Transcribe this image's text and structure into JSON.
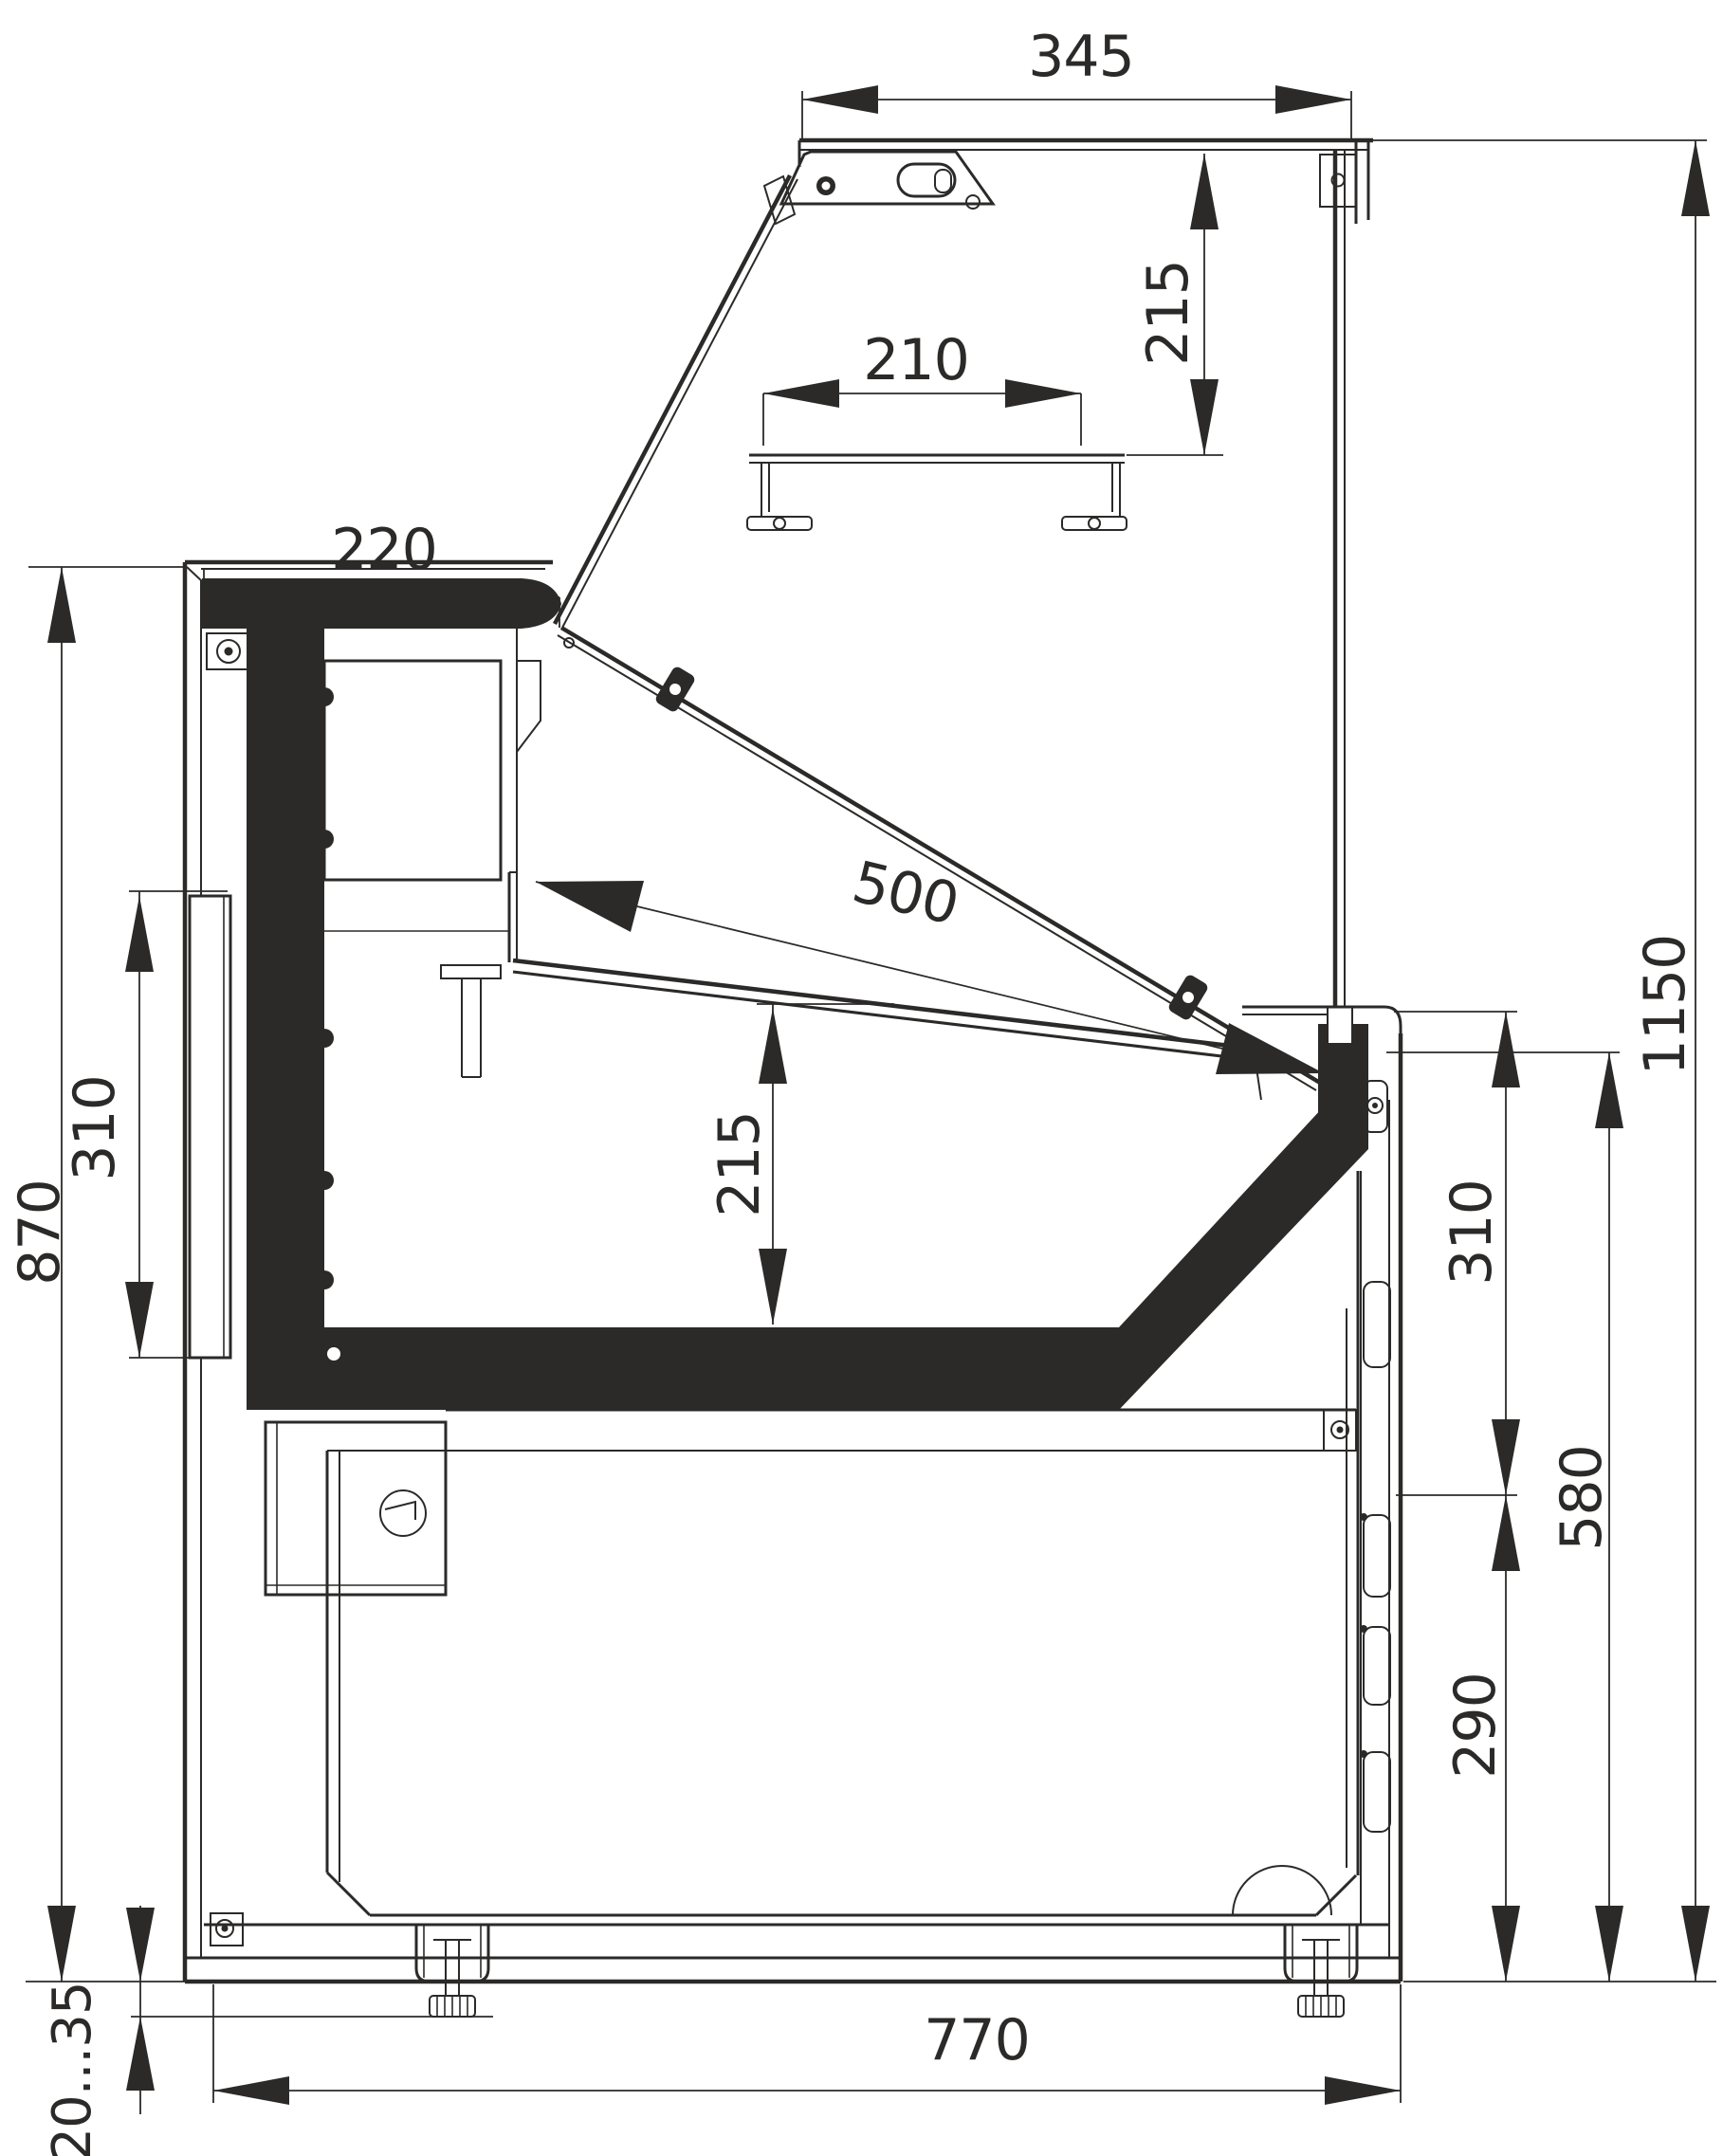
{
  "drawing": {
    "type": "technical-cross-section",
    "subject": "refrigerated-display-counter-side-view",
    "colors": {
      "line": "#2b2a29",
      "background": "#ffffff"
    },
    "dimensions": {
      "canopy_width": {
        "label": "345"
      },
      "canopy_height": {
        "label": "215"
      },
      "rear_top_width": {
        "label": "220"
      },
      "shelf_width": {
        "label": "210"
      },
      "deck_length": {
        "label": "500"
      },
      "well_depth": {
        "label": "215"
      },
      "rear_panel_height": {
        "label": "310"
      },
      "worktop_height": {
        "label": "870"
      },
      "total_height": {
        "label": "1150"
      },
      "front_upper_height": {
        "label": "310"
      },
      "front_lower_height": {
        "label": "580"
      },
      "vent_zone_height": {
        "label": "290"
      },
      "base_depth": {
        "label": "770"
      },
      "foot_adjust_range": {
        "label": "20...35"
      }
    }
  }
}
